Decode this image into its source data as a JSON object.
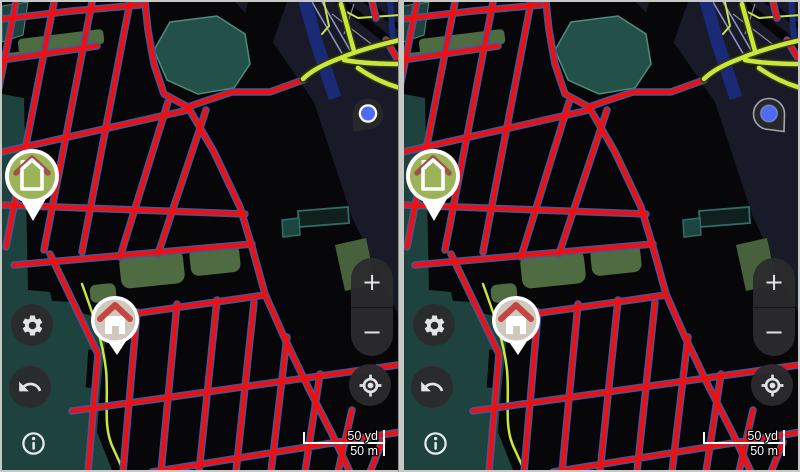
{
  "panels": [
    {
      "name": "left map view",
      "location_pin_style": "plain dark pin, tail bottom-left, white-ringed blue dot"
    },
    {
      "name": "right map view",
      "location_pin_style": "outlined dark pin, tail bottom-right, blue dot"
    }
  ],
  "controls": {
    "zoom_in_label": "+",
    "zoom_out_label": "−"
  },
  "scale_bar": {
    "imperial": "50 yd",
    "metric": "50 m"
  },
  "icons": {
    "settings": "gear-icon",
    "undo": "undo-arrow-icon",
    "info": "info-icon",
    "locate": "my-location-icon",
    "zoom_in": "plus-icon",
    "zoom_out": "minus-icon",
    "location_pin": "location-pin-icon",
    "home_marker_green": "home-marker-green-icon",
    "home_marker_beige": "home-marker-beige-icon"
  },
  "palette": {
    "divider": "#c7c9c6",
    "map-bg": "#070709",
    "navy": "#181a28",
    "teal": "#1e423e",
    "teal-stroke": "#4f8c7d",
    "octagon": "#24504a",
    "olive": "#4e6b42",
    "road-red": "#f50d0d",
    "road-casing": "#4d5390",
    "chartreuse": "#c9e63e",
    "chartreuse-casing": "#2e3a08",
    "blue-road": "#1b2a77",
    "purple-line": "#8b92c8",
    "btn-bg": "#2b2b2d",
    "icon-color": "#e9ebea",
    "scale-text": "#ffffff",
    "location-blue": "#4d6cf2",
    "pin-dark": "#26262b",
    "pin-outline": "#a3a5ac",
    "marker-green": "#9cb457",
    "marker-beige": "#cfc8bc",
    "roof-red": "#c4463e",
    "roof-dark-red": "#a0514b"
  }
}
